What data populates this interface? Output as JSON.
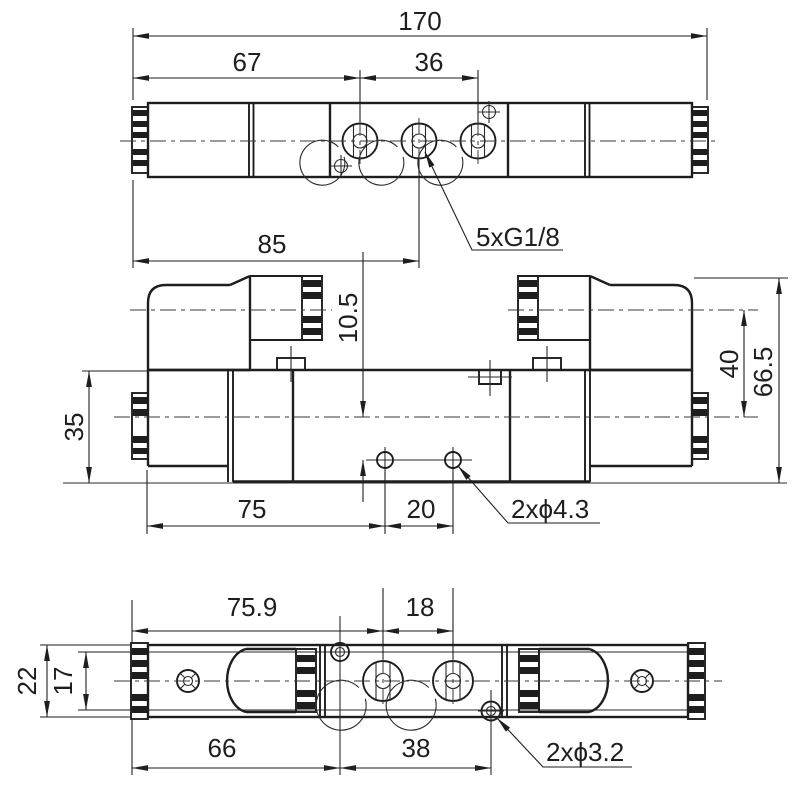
{
  "drawing": {
    "kind": "solenoid-valve-dimension-drawing",
    "colors": {
      "line": "#1e1e1e",
      "background": "#ffffff"
    },
    "views": {
      "top": {
        "dims": {
          "length": "170",
          "left_to_outer_port": "67",
          "outer_port_span": "36",
          "left_to_center_port": "85",
          "port_thread": "5xG1/8"
        }
      },
      "front": {
        "dims": {
          "body_height": "35",
          "axis_to_holes": "10.5",
          "axis_to_coil_axis": "40",
          "total_height": "66.5",
          "left_to_hole": "75",
          "hole_span": "20",
          "hole_note": "2xϕ4.3"
        }
      },
      "bottom": {
        "dims": {
          "left_to_port": "75.9",
          "port_span": "18",
          "width": "22",
          "inner_width": "17",
          "left_to_hole": "66",
          "hole_span": "38",
          "hole_note": "2xϕ3.2"
        }
      }
    }
  }
}
